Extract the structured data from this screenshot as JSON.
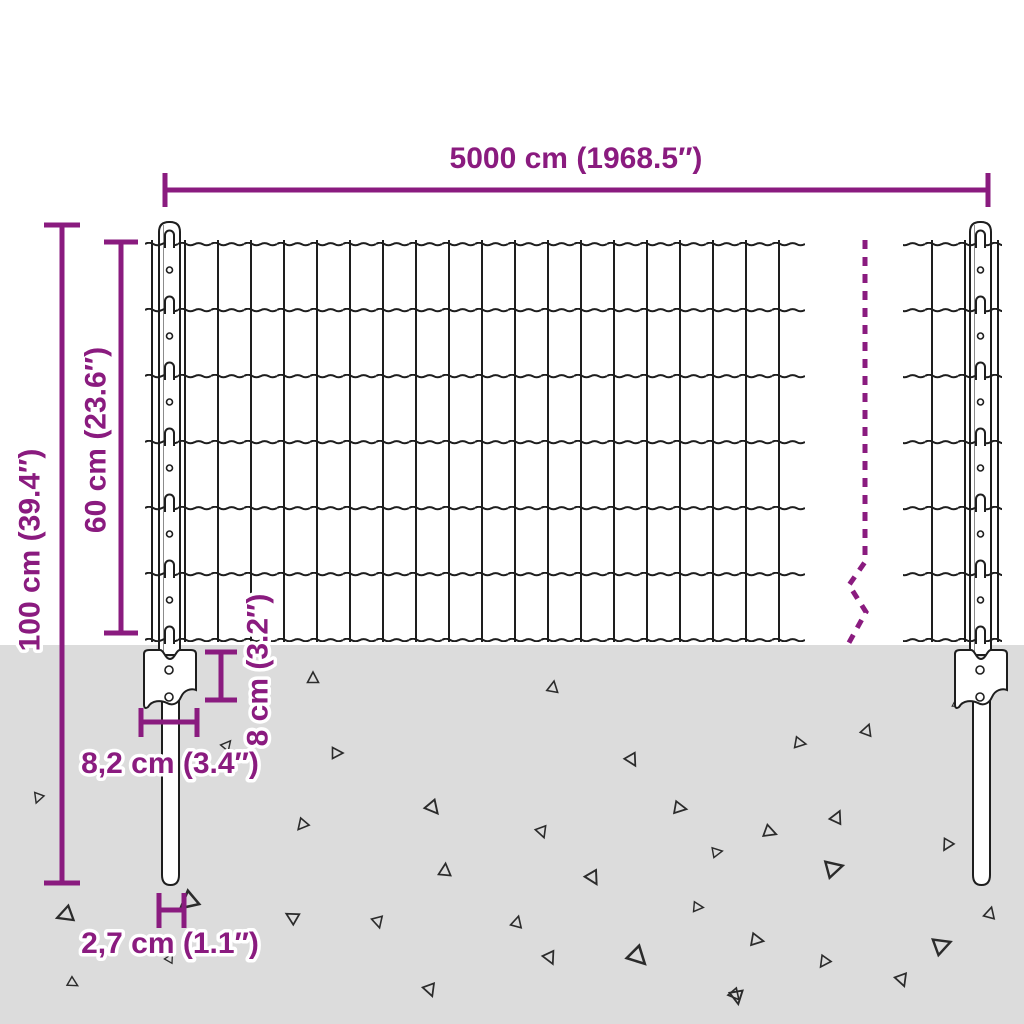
{
  "diagram": {
    "subject": "fence-panel-with-posts-dimension-diagram",
    "dimensions": {
      "total_width_label": "5000 cm (1968.5″)",
      "total_height_label": "100 cm (39.4″)",
      "mesh_height_label": "60 cm (23.6″)",
      "anchor_plate_height_label": "8 cm (3.2″)",
      "anchor_plate_width_label": "8,2 cm (3.4″)",
      "post_diameter_label": "2,7 cm (1.1″)"
    },
    "colors": {
      "dimension_accent": "#8a1b7f",
      "drawing_line": "#1e1e1e",
      "ground": "#dcdcdc",
      "background": "#ffffff"
    },
    "ground": {
      "top_y": 645,
      "stones": [
        [
          313,
          678,
          1.0,
          0
        ],
        [
          553,
          687,
          1.0,
          10
        ],
        [
          337,
          753,
          1.0,
          90
        ],
        [
          632,
          760,
          1.1,
          150
        ],
        [
          433,
          808,
          1.2,
          140
        ],
        [
          302,
          825,
          1.0,
          220
        ],
        [
          542,
          832,
          1.0,
          160
        ],
        [
          680,
          808,
          1.1,
          100
        ],
        [
          717,
          852,
          0.9,
          80
        ],
        [
          445,
          870,
          1.1,
          5
        ],
        [
          593,
          878,
          1.2,
          150
        ],
        [
          378,
          922,
          1.0,
          165
        ],
        [
          517,
          922,
          1.0,
          15
        ],
        [
          698,
          907,
          0.9,
          95
        ],
        [
          550,
          958,
          1.1,
          155
        ],
        [
          638,
          957,
          1.6,
          135
        ],
        [
          430,
          990,
          1.1,
          160
        ],
        [
          737,
          997,
          1.2,
          170
        ],
        [
          38,
          798,
          0.9,
          200
        ],
        [
          65,
          915,
          1.4,
          250
        ],
        [
          73,
          983,
          0.9,
          120
        ],
        [
          188,
          902,
          1.6,
          230
        ],
        [
          227,
          745,
          0.9,
          40
        ],
        [
          292,
          917,
          1.1,
          300
        ],
        [
          170,
          958,
          0.8,
          30
        ],
        [
          867,
          730,
          1.0,
          20
        ],
        [
          800,
          743,
          1.0,
          100
        ],
        [
          837,
          817,
          1.1,
          25
        ],
        [
          770,
          832,
          1.1,
          110
        ],
        [
          947,
          845,
          1.0,
          210
        ],
        [
          834,
          868,
          1.5,
          75
        ],
        [
          990,
          913,
          1.0,
          15
        ],
        [
          757,
          940,
          1.1,
          100
        ],
        [
          942,
          945,
          1.5,
          70
        ],
        [
          824,
          962,
          1.0,
          215
        ],
        [
          902,
          980,
          1.1,
          160
        ],
        [
          735,
          995,
          1.0,
          140
        ],
        [
          956,
          703,
          0.7,
          0
        ]
      ]
    }
  }
}
